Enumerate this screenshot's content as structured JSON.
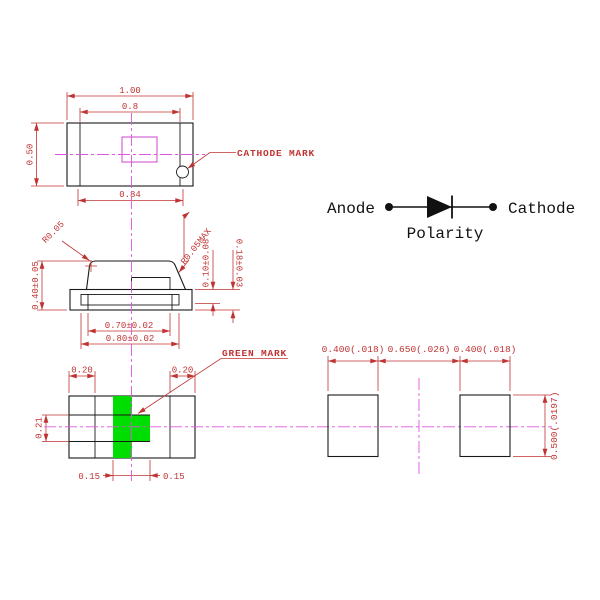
{
  "colors": {
    "background": "#ffffff",
    "outline": "#1a1a1a",
    "dimension_red": "#c03333",
    "centerline_magenta": "#dd55dd",
    "green_mark": "#00dd00",
    "terminal_hatch_green": "#90d890",
    "die_outline_magenta": "#cc44cc"
  },
  "top_view": {
    "dim_body_width": "1.00",
    "dim_inner_width": "0.8",
    "dim_terminal_span": "0.84",
    "dim_body_height": "0.50",
    "cathode_label": "CATHODE MARK"
  },
  "side_view": {
    "corner_radius": "R0.05",
    "corner_radius_max": "R0.05MAX",
    "dim_height": "0.40±0.05",
    "dim_electrode_thickness": "0.10±0.08",
    "dim_base_thickness": "0.18±0.03",
    "dim_inner_width": "0.70±0.02",
    "dim_outer_width": "0.80±0.02"
  },
  "bottom_view": {
    "dim_terminal_left": "0.20",
    "dim_terminal_right": "0.20",
    "dim_mark_height": "0.21",
    "dim_mark_left": "0.15",
    "dim_mark_right": "0.15",
    "green_label": "GREEN MARK"
  },
  "polarity": {
    "anode": "Anode",
    "cathode": "Cathode",
    "caption": "Polarity"
  },
  "pad_layout": {
    "dim_pad_left": "0.400(.018)",
    "dim_pitch": "0.650(.026)",
    "dim_pad_right": "0.400(.018)",
    "dim_pad_height": "0.500(.0197)"
  }
}
